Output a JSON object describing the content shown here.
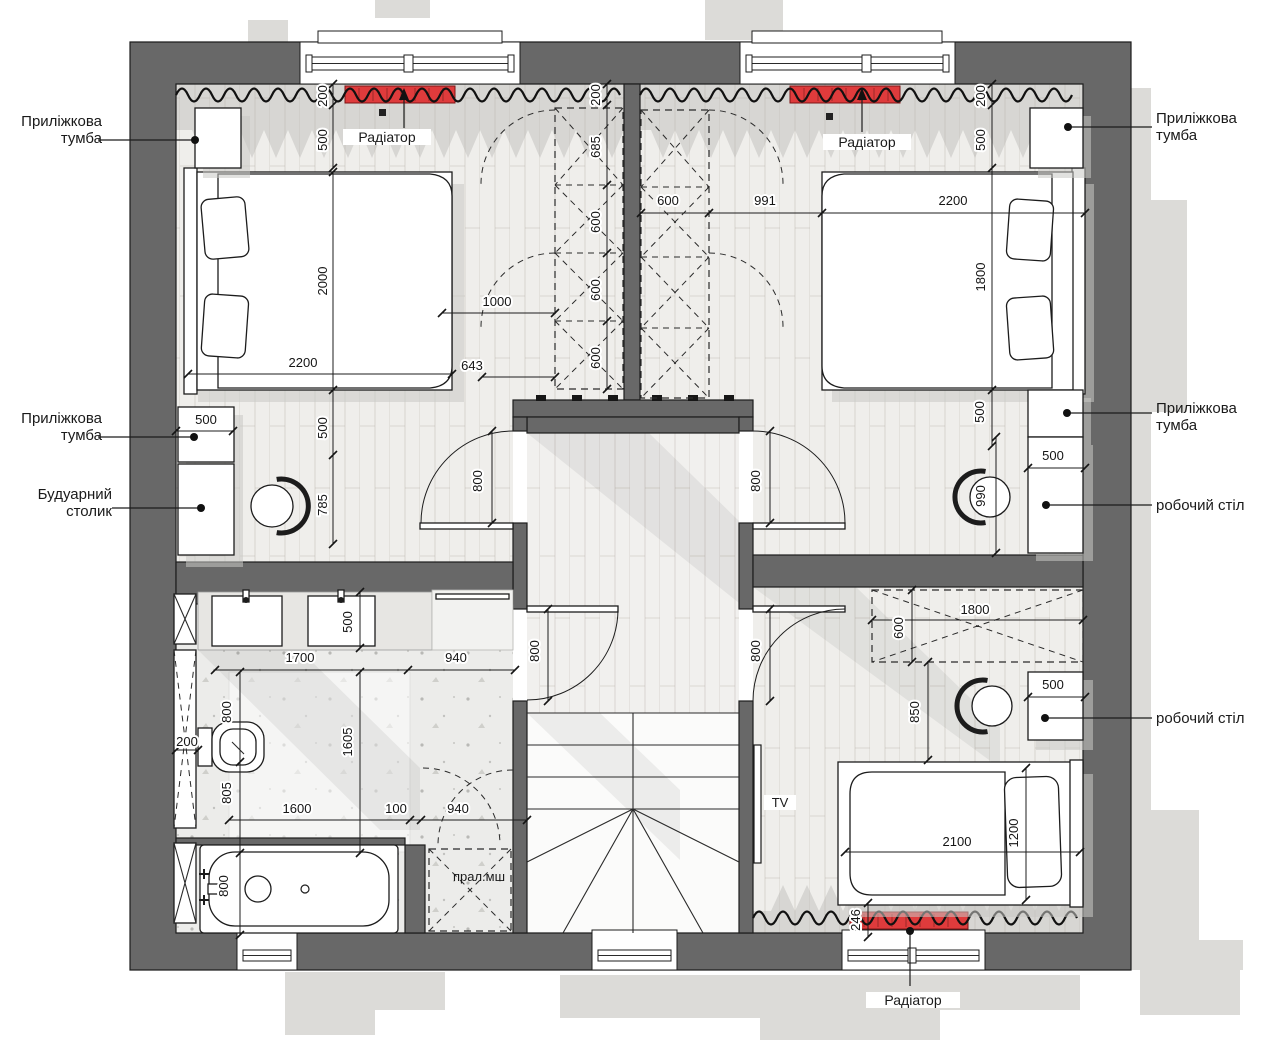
{
  "colors": {
    "wall": "#686868",
    "radiator": "#df3b3c",
    "exterior_shadow": "#dcdbd8",
    "wood_floor": "#efeeeb",
    "bath_floor": "#ececea",
    "line": "#1c1c1c"
  },
  "callouts": {
    "bedside_top_left": {
      "line1": "Приліжкова",
      "line2": "тумба"
    },
    "bedside_mid_left": {
      "line1": "Приліжкова",
      "line2": "тумба"
    },
    "boudoir": {
      "line1": "Будуарний",
      "line2": "столик"
    },
    "bedside_top_right": {
      "line1": "Приліжкова",
      "line2": "тумба"
    },
    "bedside_mid_right": {
      "line1": "Приліжкова",
      "line2": "тумба"
    },
    "desk_right_1": {
      "line1": "робочий стіл"
    },
    "desk_right_2": {
      "line1": "робочий стіл"
    },
    "radiator_top_left": "Радіатор",
    "radiator_top_right": "Радіатор",
    "radiator_bottom": "Радіатор",
    "washer": "прал.мш",
    "tv": "TV"
  },
  "dims": [
    "200",
    "500",
    "2000",
    "2200",
    "500",
    "500",
    "785",
    "1000",
    "643",
    "200",
    "685",
    "600",
    "600",
    "600",
    "600",
    "991",
    "2200",
    "200",
    "500",
    "1800",
    "500",
    "500",
    "990",
    "800",
    "800",
    "500",
    "1700",
    "940",
    "800",
    "800",
    "800",
    "200",
    "805",
    "1605",
    "1600",
    "100",
    "940",
    "800",
    "1800",
    "600",
    "850",
    "500",
    "2100",
    "1200",
    "246"
  ]
}
